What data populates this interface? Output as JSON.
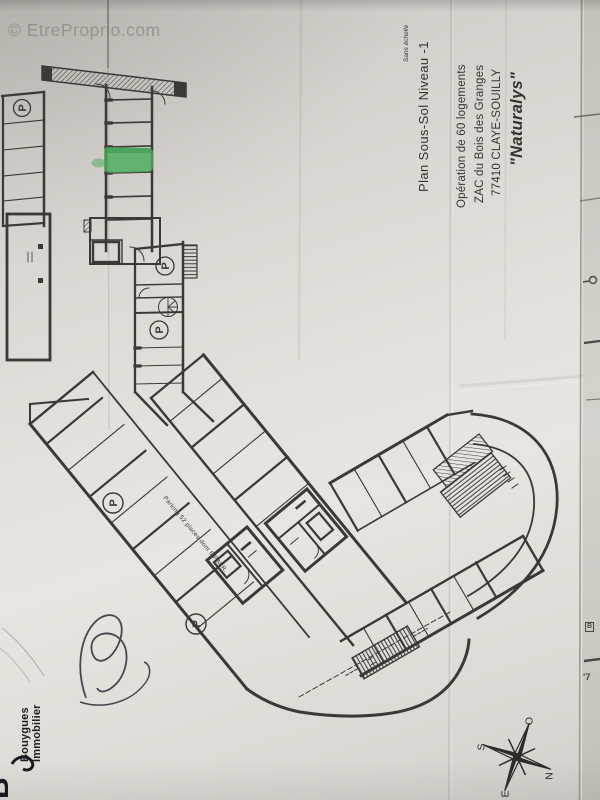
{
  "watermark": {
    "text": "© EtreProprio.com"
  },
  "title_block": {
    "project_name": "\"Naturalys\"",
    "project_line1": "Opération de 60 logements",
    "project_line2": "ZAC du Bois des Granges",
    "project_line3": "77410 CLAYE-SOUILLY",
    "drawing_title": "Plan Sous-Sol Niveau -1",
    "scale_note": "Sans échelle"
  },
  "plan": {
    "aisle_label": "Parking  52 places dont 6 P.M.R.",
    "parking_symbol": "P",
    "highlight_color": "#49b05c",
    "ink_color": "#3b3935"
  },
  "compass": {
    "north": "N",
    "south": "S",
    "east": "E",
    "west": "O"
  },
  "branding": {
    "company_line1": "Bouygues",
    "company_line2": "Immobilier",
    "logo_letter": "B"
  },
  "edge_fragments": {
    "fragment_b": "B",
    "fragment_7": "'7"
  }
}
